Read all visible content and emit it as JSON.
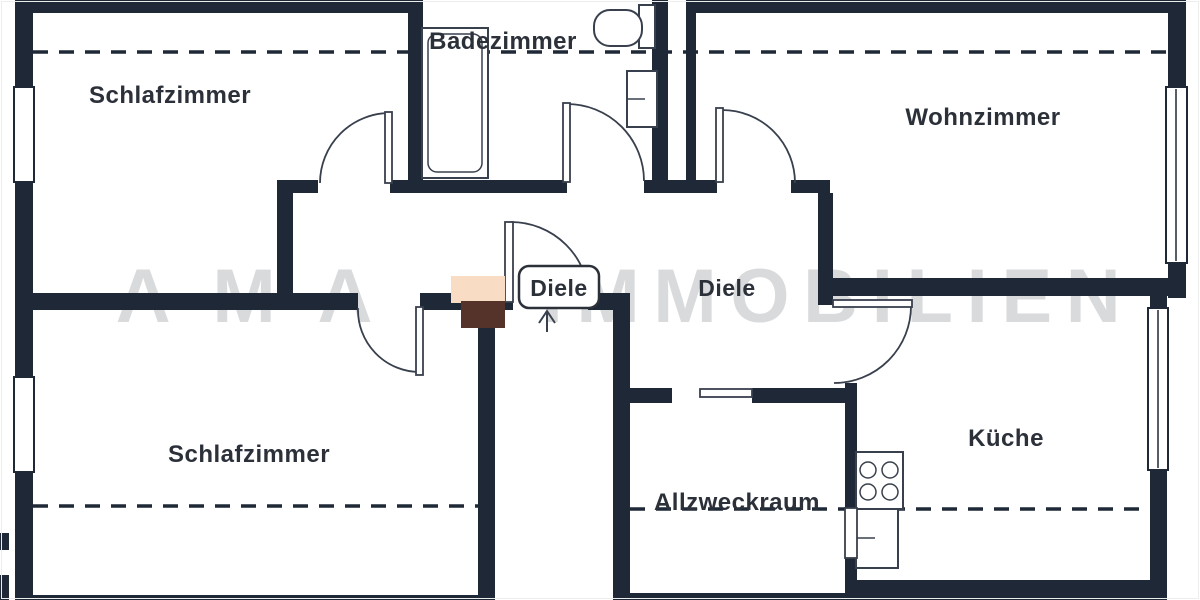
{
  "floorplan": {
    "title": "Apartment floor plan",
    "watermark": {
      "part1": "AMA",
      "part2": "IMMOBILIEN"
    },
    "rooms": {
      "schlafzimmer_top": "Schlafzimmer",
      "badezimmer": "Badezimmer",
      "wohnzimmer": "Wohnzimmer",
      "diele_boxed": "Diele",
      "diele_open": "Diele",
      "schlafzimmer_bottom": "Schlafzimmer",
      "allzweckraum": "Allzweckraum",
      "kueche": "Küche"
    },
    "colors": {
      "wall": "#1f2836",
      "text": "#2b3039",
      "line": "#39404d",
      "watermark": "#d8dadc",
      "logo_light": "#f8dcc4",
      "logo_dark": "#55322a",
      "background": "#ffffff"
    }
  }
}
